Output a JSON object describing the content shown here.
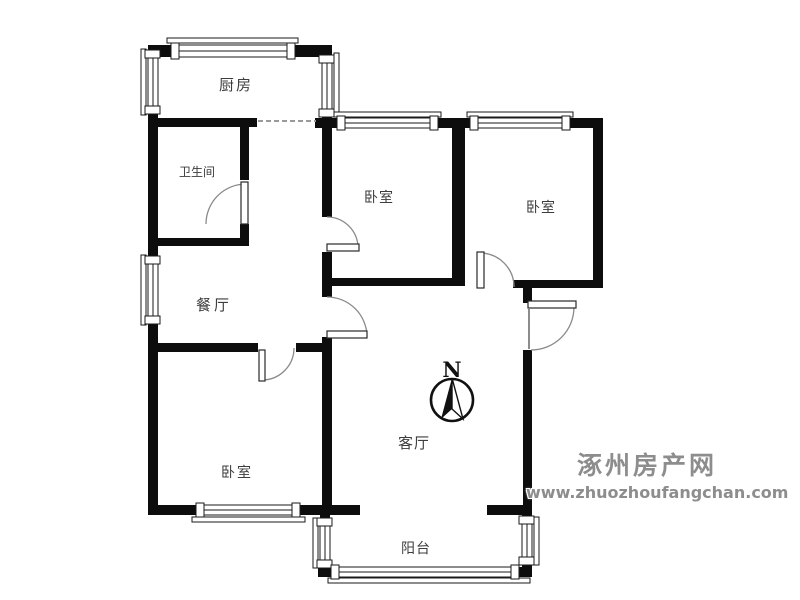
{
  "rooms": {
    "kitchen": {
      "label": "厨房"
    },
    "bathroom": {
      "label": "卫生间"
    },
    "bedroom_top_mid": {
      "label": "卧室"
    },
    "bedroom_top_right": {
      "label": "卧室"
    },
    "dining": {
      "label": "餐厅"
    },
    "living": {
      "label": "客厅"
    },
    "bedroom_bottom": {
      "label": "卧室"
    },
    "balcony": {
      "label": "阳台"
    }
  },
  "compass": {
    "label": "N"
  },
  "watermark": {
    "site_name": "涿州房产网",
    "site_url": "www.zhuozhoufangchan.com"
  },
  "colors": {
    "wall": "#0d0d0d",
    "door_swing": "#8a8a8a",
    "room_label": "#3d3d3d",
    "watermark": "#8d8d8d",
    "background": "#ffffff"
  }
}
